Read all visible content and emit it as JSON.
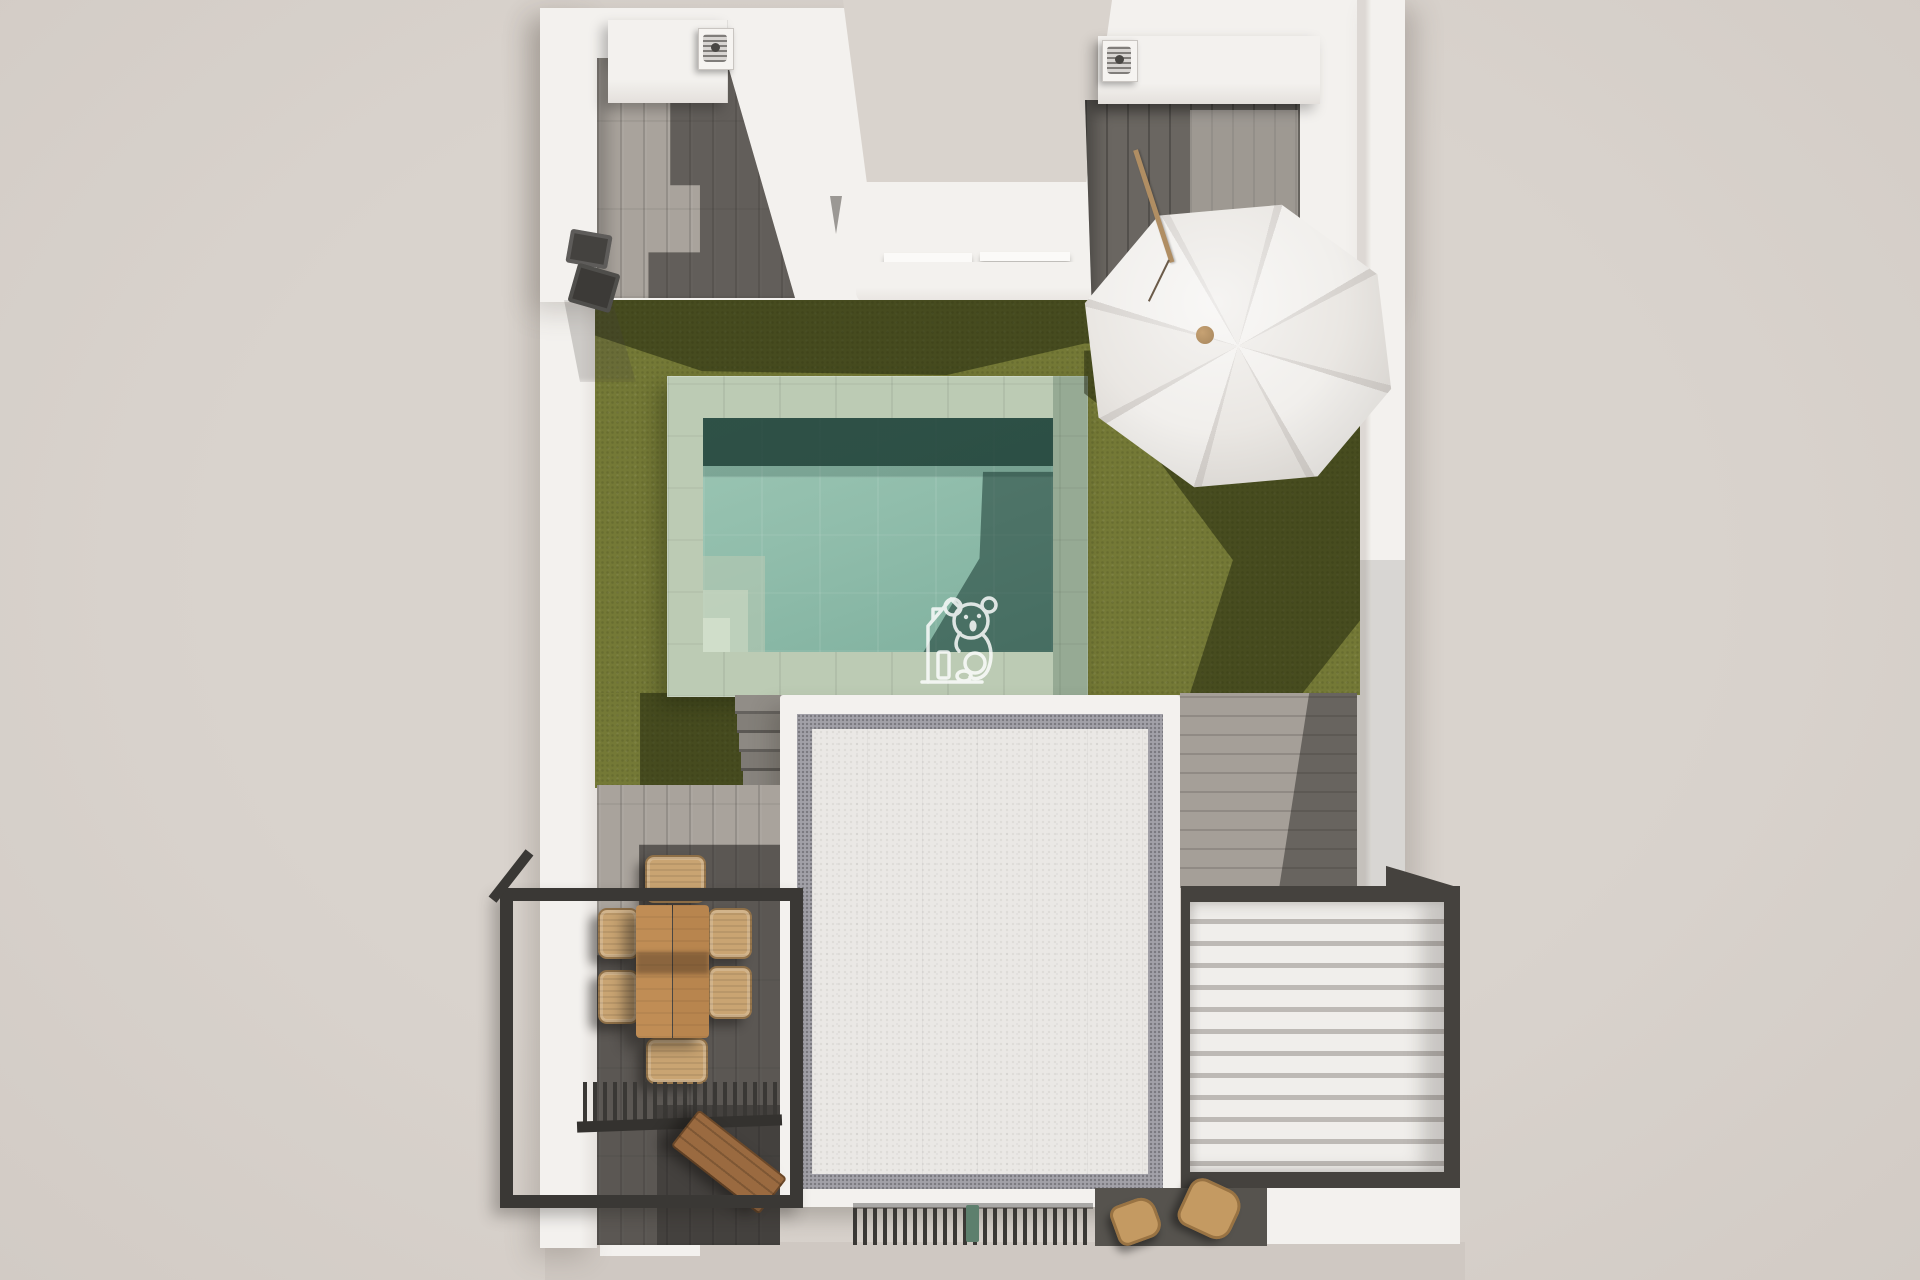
{
  "scene": {
    "type": "3d-render-top-down",
    "subject": "villa roof terrace plan with swimming pool, lawn, parasol, dining set and louvered pergola",
    "visible_text": "none"
  },
  "watermark": {
    "name": "koala-house-logo",
    "style": "white line art, semi-transparent"
  },
  "palette": {
    "bg": "#d9d3cd",
    "ground": "#cfc8c2",
    "wall": "#f3f1ee",
    "wall_shade": "#dedad6",
    "deck_light": "#a9a39c",
    "deck_dark": "#6a6661",
    "deck_right": "#a59f98",
    "lawn": "#747936",
    "coping": "#bccbb4",
    "coping_dark": "#93aa97",
    "water": "#90bdab",
    "water_dark": "#2e5144",
    "gravel": "#eae8e5",
    "gravel_band": "#a2a1a8",
    "frame": "#3a3835",
    "pergola_frame": "#45423e",
    "louver": "#f0eeeb",
    "louver_gap": "#bdb9b5",
    "table_wood": "#b8854e",
    "chair_wicker": "#c9a472",
    "bench_wood": "#9a6a40",
    "umbrella": "#f1efec",
    "umbrella_alt": "#eae7e3",
    "umbrella_seam": "#d7d3cf",
    "pole": "#b08e63",
    "green_item": "#5d7f6d",
    "watermark": "#ffffff"
  },
  "objects": {
    "pool": "swimming pool with steps",
    "lawn": "artificial lawn",
    "umbrella": "tilted patio parasol",
    "dining_set": "wooden dining table with six wicker chairs",
    "pergola": "white louvered pergola roof",
    "roof": "white gravel flat roof",
    "railing": "black metal terrace railing",
    "grate": "black slatted pergola grate",
    "bench": "wooden bench",
    "stairs": "garden stairs",
    "ac_units": "rooftop air-conditioning units",
    "watermark": "koala house logo watermark"
  }
}
